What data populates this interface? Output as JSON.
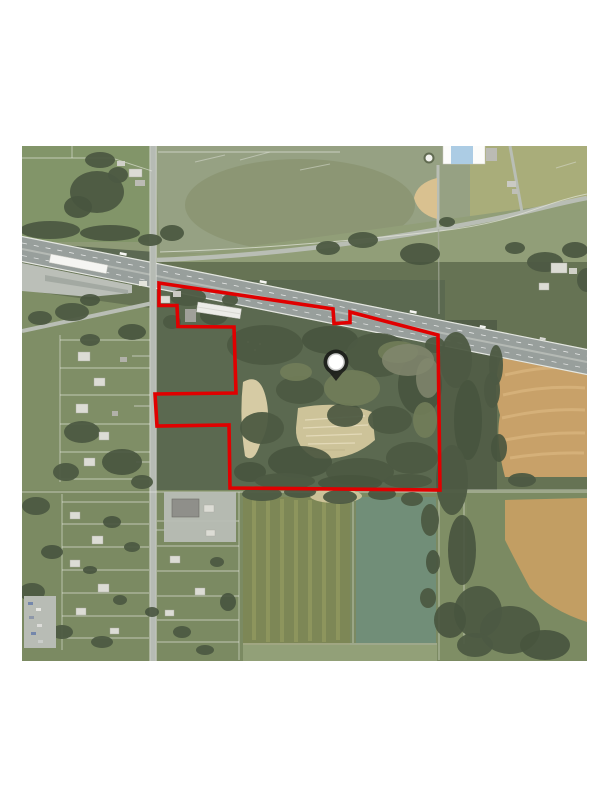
{
  "document": {
    "type": "aerial-map-figure",
    "background": "#ffffff"
  },
  "map": {
    "kind": "satellite-aerial-photo",
    "frame": {
      "left": 22,
      "top": 146,
      "width": 565,
      "height": 515
    },
    "boundary": {
      "label": "property-outline",
      "color": "#e00000",
      "stroke_width": 3.6,
      "points": "159,283 333,309 334,323.5 350,322.5 350,312 438,335 440,490 230,488 229,425 157,426 155,394 236,393 234,327 178,326.5 177,305.5 159,305.5"
    },
    "marker": {
      "label": "subject-location-pin",
      "transform": "translate(336,362)",
      "halo_color": "#141414",
      "halo_opacity": "0.82",
      "fill": "#ffffff",
      "ring_color": "#cfcfcf"
    },
    "palette": {
      "field_green": "#8a9670",
      "pasture_green": "#929d7e",
      "woods_green": "#546248",
      "crop_orange": "#c79e62",
      "dirt_tan": "#d3c69a",
      "road_gray": "#b4b9b2",
      "highway_gray": "#949b98"
    }
  }
}
